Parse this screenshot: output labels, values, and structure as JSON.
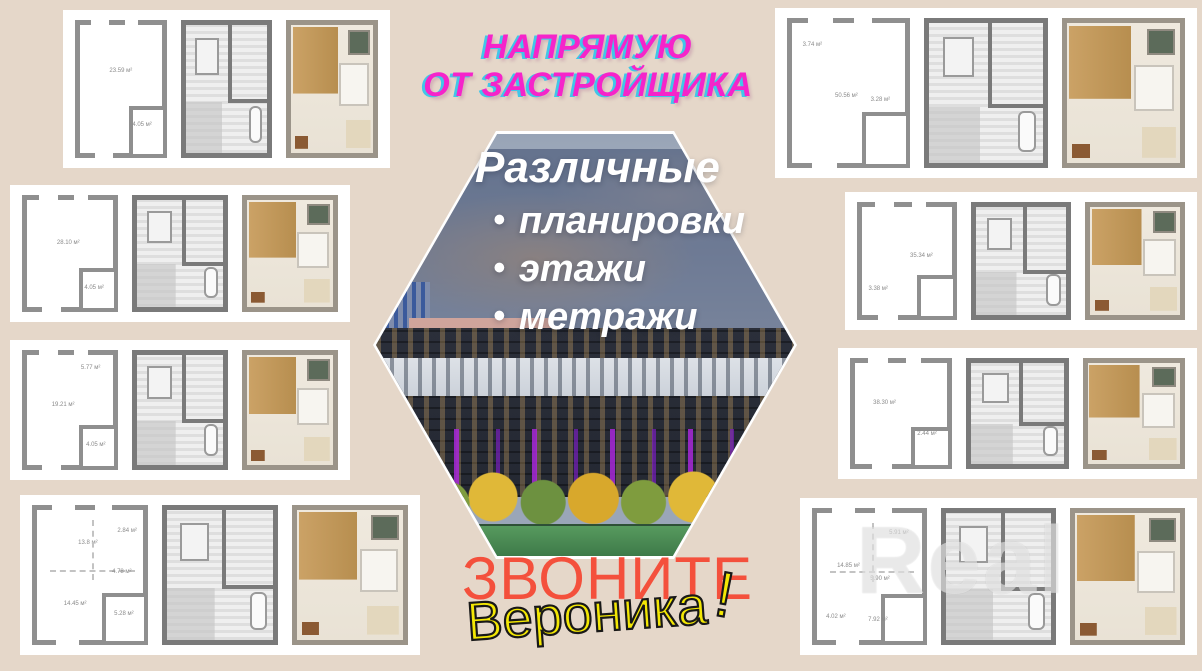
{
  "poster": {
    "bg": "#e5d7c9"
  },
  "headline": {
    "line1": "НАПРЯМУЮ",
    "line2": "ОТ ЗАСТРОЙЩИКА",
    "color": "#f524ca",
    "shadow_color": "#41c6e8"
  },
  "hexagon": {
    "title": "Различные",
    "bullet_char": "•",
    "bullets": [
      "планировки",
      "этажи",
      "метражи"
    ],
    "text_color": "#ffffff",
    "overlay_color": "rgba(52,68,104,0.52)",
    "accent_purple": "#a828d8",
    "grass_green": "#3e7a49"
  },
  "call": {
    "label": "ЗВОНИТЕ",
    "color": "#f4503c"
  },
  "signature": {
    "name": "Вероника",
    "mark": "!",
    "color": "#f3e704",
    "stroke": "#181818"
  },
  "watermark": {
    "text": "Real"
  },
  "cards": [
    {
      "id": "card-top-left",
      "x": 63,
      "y": 10,
      "w": 327,
      "h": 158,
      "plans": [
        {
          "type": "outline",
          "labels": [
            {
              "t": "23.59 м²",
              "x": 50,
              "y": 36
            },
            {
              "t": "4.05 м²",
              "x": 76,
              "y": 78
            }
          ]
        },
        {
          "type": "detailed",
          "labels": []
        },
        {
          "type": "render",
          "labels": []
        }
      ]
    },
    {
      "id": "card-left-upper",
      "x": 10,
      "y": 185,
      "w": 340,
      "h": 137,
      "plans": [
        {
          "type": "outline",
          "labels": [
            {
              "t": "28.10 м²",
              "x": 48,
              "y": 40
            },
            {
              "t": "4.05 м²",
              "x": 78,
              "y": 82
            }
          ]
        },
        {
          "type": "detailed",
          "labels": []
        },
        {
          "type": "render",
          "labels": []
        }
      ]
    },
    {
      "id": "card-left-lower",
      "x": 10,
      "y": 340,
      "w": 340,
      "h": 140,
      "plans": [
        {
          "type": "outline",
          "labels": [
            {
              "t": "19.21 м²",
              "x": 42,
              "y": 45
            },
            {
              "t": "5.77 м²",
              "x": 74,
              "y": 12
            },
            {
              "t": "4.05 м²",
              "x": 80,
              "y": 82
            }
          ]
        },
        {
          "type": "detailed",
          "labels": []
        },
        {
          "type": "render",
          "labels": []
        }
      ]
    },
    {
      "id": "card-bottom-left",
      "x": 20,
      "y": 495,
      "w": 400,
      "h": 160,
      "plans": [
        {
          "type": "outline",
          "labels": [
            {
              "t": "13.8 м²",
              "x": 48,
              "y": 25
            },
            {
              "t": "2.84 м²",
              "x": 85,
              "y": 16
            },
            {
              "t": "4.78 м²",
              "x": 80,
              "y": 48
            },
            {
              "t": "14.45 м²",
              "x": 36,
              "y": 72
            },
            {
              "t": "5.28 м²",
              "x": 82,
              "y": 80
            }
          ]
        },
        {
          "type": "detailed",
          "labels": []
        },
        {
          "type": "render",
          "labels": []
        }
      ]
    },
    {
      "id": "card-top-right",
      "x": 775,
      "y": 8,
      "w": 422,
      "h": 170,
      "plans": [
        {
          "type": "outline",
          "labels": [
            {
              "t": "3.74 м²",
              "x": 18,
              "y": 16
            },
            {
              "t": "50.56 м²",
              "x": 48,
              "y": 52
            },
            {
              "t": "3.28 м²",
              "x": 78,
              "y": 55
            }
          ]
        },
        {
          "type": "detailed",
          "labels": []
        },
        {
          "type": "render",
          "labels": []
        }
      ]
    },
    {
      "id": "card-right-upper",
      "x": 845,
      "y": 192,
      "w": 352,
      "h": 138,
      "plans": [
        {
          "type": "outline",
          "labels": [
            {
              "t": "35.34 м²",
              "x": 66,
              "y": 45
            },
            {
              "t": "3.38 м²",
              "x": 18,
              "y": 76
            }
          ]
        },
        {
          "type": "detailed",
          "labels": []
        },
        {
          "type": "render",
          "labels": []
        }
      ]
    },
    {
      "id": "card-right-lower",
      "x": 838,
      "y": 348,
      "w": 359,
      "h": 131,
      "plans": [
        {
          "type": "outline",
          "labels": [
            {
              "t": "38.30 м²",
              "x": 32,
              "y": 40
            },
            {
              "t": "2.44 м²",
              "x": 78,
              "y": 70
            }
          ]
        },
        {
          "type": "detailed",
          "labels": []
        },
        {
          "type": "render",
          "labels": []
        }
      ]
    },
    {
      "id": "card-bottom-right",
      "x": 800,
      "y": 498,
      "w": 397,
      "h": 157,
      "plans": [
        {
          "type": "outline",
          "labels": [
            {
              "t": "14.85 м²",
              "x": 30,
              "y": 42
            },
            {
              "t": "5.91 м²",
              "x": 78,
              "y": 16
            },
            {
              "t": "5.90 м²",
              "x": 60,
              "y": 52
            },
            {
              "t": "4.02 м²",
              "x": 18,
              "y": 82
            },
            {
              "t": "7.92 м²",
              "x": 58,
              "y": 84
            }
          ]
        },
        {
          "type": "detailed",
          "labels": []
        },
        {
          "type": "render",
          "labels": []
        }
      ]
    }
  ]
}
